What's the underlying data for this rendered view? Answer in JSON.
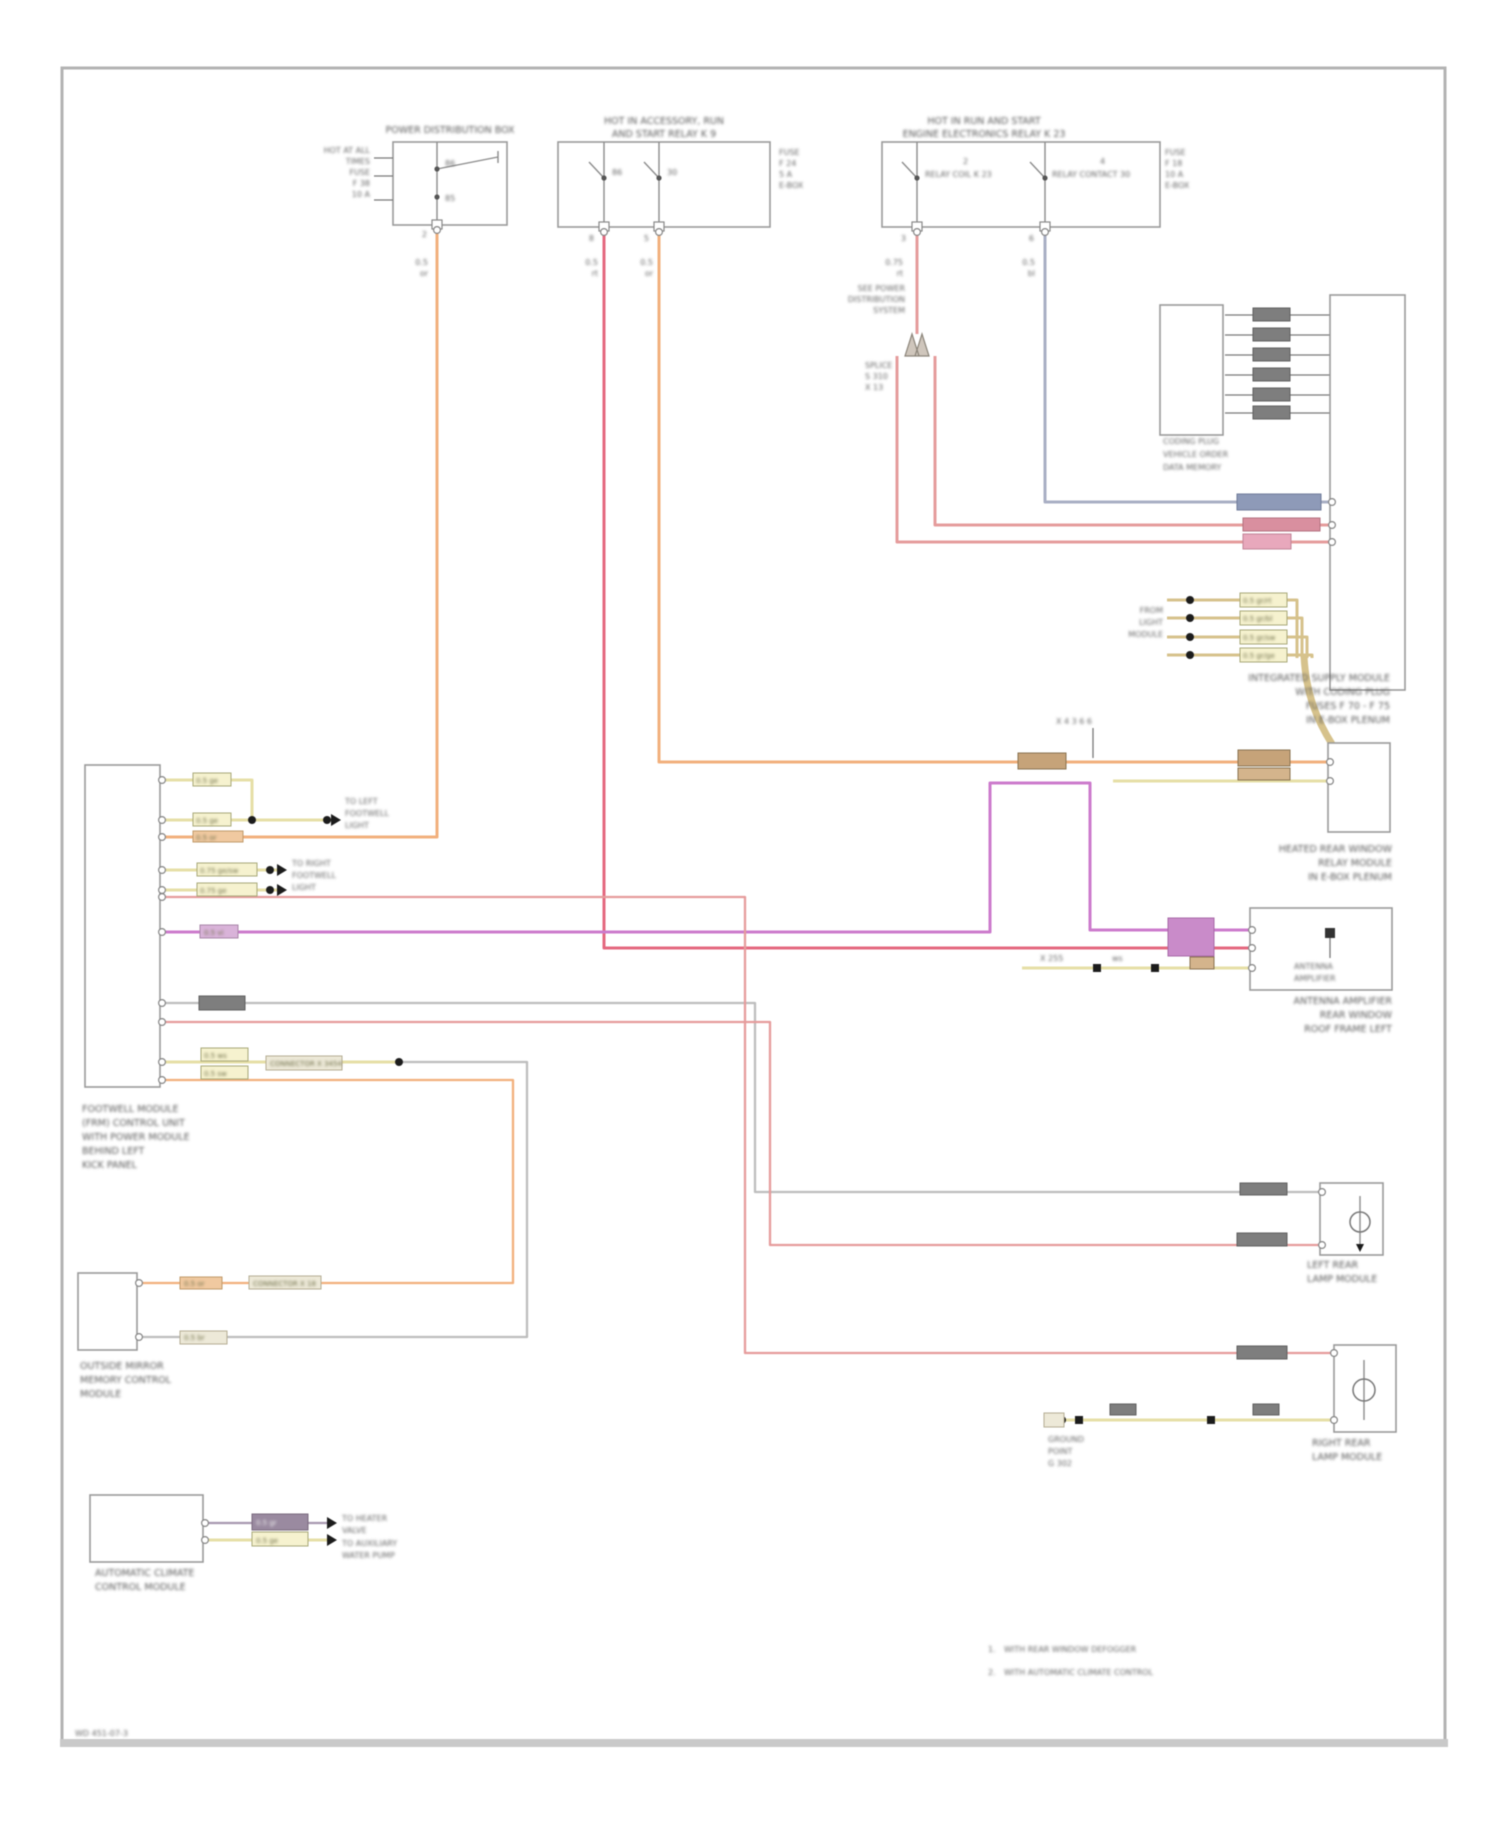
{
  "boxA": {
    "cap": "POWER DISTRIBUTION BOX",
    "side": [
      "HOT AT ALL",
      "TIMES",
      "FUSE",
      "F 38",
      "10 A"
    ],
    "c1": "86",
    "c2": "85",
    "pin": "2",
    "w": [
      "0.5",
      "or"
    ]
  },
  "b": {
    "cap": [
      "HOT IN ACCESSORY, RUN",
      "AND START  RELAY K 9"
    ],
    "right": [
      "FUSE",
      "F 24",
      "5 A",
      "E-BOX"
    ],
    "k1": "86",
    "k2": "30",
    "p1": "8",
    "p2": "5",
    "w1": [
      "0.5",
      "rt"
    ],
    "w2": [
      "0.5",
      "or"
    ]
  },
  "c": {
    "cap": [
      "HOT IN RUN AND START",
      "ENGINE ELECTRONICS RELAY K 23"
    ],
    "k1": "2",
    "k2": "4",
    "co1": "RELAY COIL K 23",
    "co2": "RELAY CONTACT 30",
    "right": [
      "FUSE",
      "F 18",
      "10 A",
      "E-BOX"
    ],
    "p1": "3",
    "p2": "6",
    "w1": [
      "0.75",
      "rt"
    ],
    "ref": [
      "SEE POWER",
      "DISTRIBUTION",
      "SYSTEM"
    ],
    "w2": [
      "0.5",
      "bl"
    ],
    "sp": [
      "SPLICE",
      "S 310",
      "X 13"
    ]
  },
  "f": {
    "cap": [
      "INTEGRATED SUPPLY MODULE",
      "WITH CODING PLUG",
      "FUSES F 70 - F 75",
      "IN E-BOX PLENUM"
    ]
  },
  "plug": {
    "cap": [
      "CODING PLUG",
      "VEHICLE ORDER",
      "DATA MEMORY"
    ]
  },
  "tanrows": {
    "left": [
      "FROM",
      "LIGHT",
      "MODULE"
    ],
    "box": [
      "0.5 gr/rt",
      "0.5 gr/bl",
      "0.5 gr/sw",
      "0.5 gr/ge"
    ]
  },
  "e": {
    "top": "X 4 3 6 6",
    "cap": [
      "HEATED REAR WINDOW",
      "RELAY MODULE",
      "IN E-BOX PLENUM"
    ]
  },
  "g": {
    "in": [
      "ANTENNA",
      "AMPLIFIER"
    ],
    "t1": "ws",
    "t2": "X 255",
    "cap": [
      "ANTENNA AMPLIFIER",
      "REAR WINDOW",
      "ROOF FRAME LEFT"
    ]
  },
  "ecu": {
    "cap": [
      "FOOTWELL MODULE",
      "(FRM) CONTROL UNIT",
      "WITH POWER MODULE",
      "BEHIND LEFT",
      "KICK PANEL"
    ],
    "r780": "0.5 ge",
    "r820": "0.5 ge",
    "r837": "0.5 or",
    "r870": "0.75 ge/sw",
    "r890": "0.75 ge",
    "r932": "0.5 vi",
    "r1062a": "0.5 ws",
    "r1062b": "0.5 sw",
    "rconn": "CONNECTOR X 3454",
    "arr": [
      "TO LEFT",
      "FOOTWELL",
      "LIGHT"
    ],
    "arrB": [
      "TO RIGHT",
      "FOOTWELL",
      "LIGHT"
    ]
  },
  "b2": {
    "or1": "0.5 or",
    "or2": "CONNECTOR X 18",
    "gr1": "0.5 br",
    "cap": [
      "OUTSIDE MIRROR",
      "MEMORY CONTROL",
      "MODULE"
    ]
  },
  "mc": {
    "cap": [
      "LEFT REAR",
      "LAMP MODULE"
    ]
  },
  "md": {
    "cap": [
      "RIGHT REAR",
      "LAMP MODULE"
    ],
    "g": [
      "GROUND",
      "POINT",
      "G 302"
    ]
  },
  "h": {
    "cap": [
      "AUTOMATIC CLIMATE",
      "CONTROL MODULE"
    ],
    "w1": "0.5 gr",
    "w2": "0.5 ge",
    "d1": [
      "TO HEATER",
      "VALVE"
    ],
    "d2": [
      "TO AUXILIARY",
      "WATER PUMP"
    ]
  },
  "legend": {
    "n1": "1.",
    "t1": "WITH REAR WINDOW DEFOGGER",
    "n2": "2.",
    "t2": "WITH AUTOMATIC CLIMATE CONTROL"
  },
  "corner": {
    "id": "WD 451-07-3"
  }
}
